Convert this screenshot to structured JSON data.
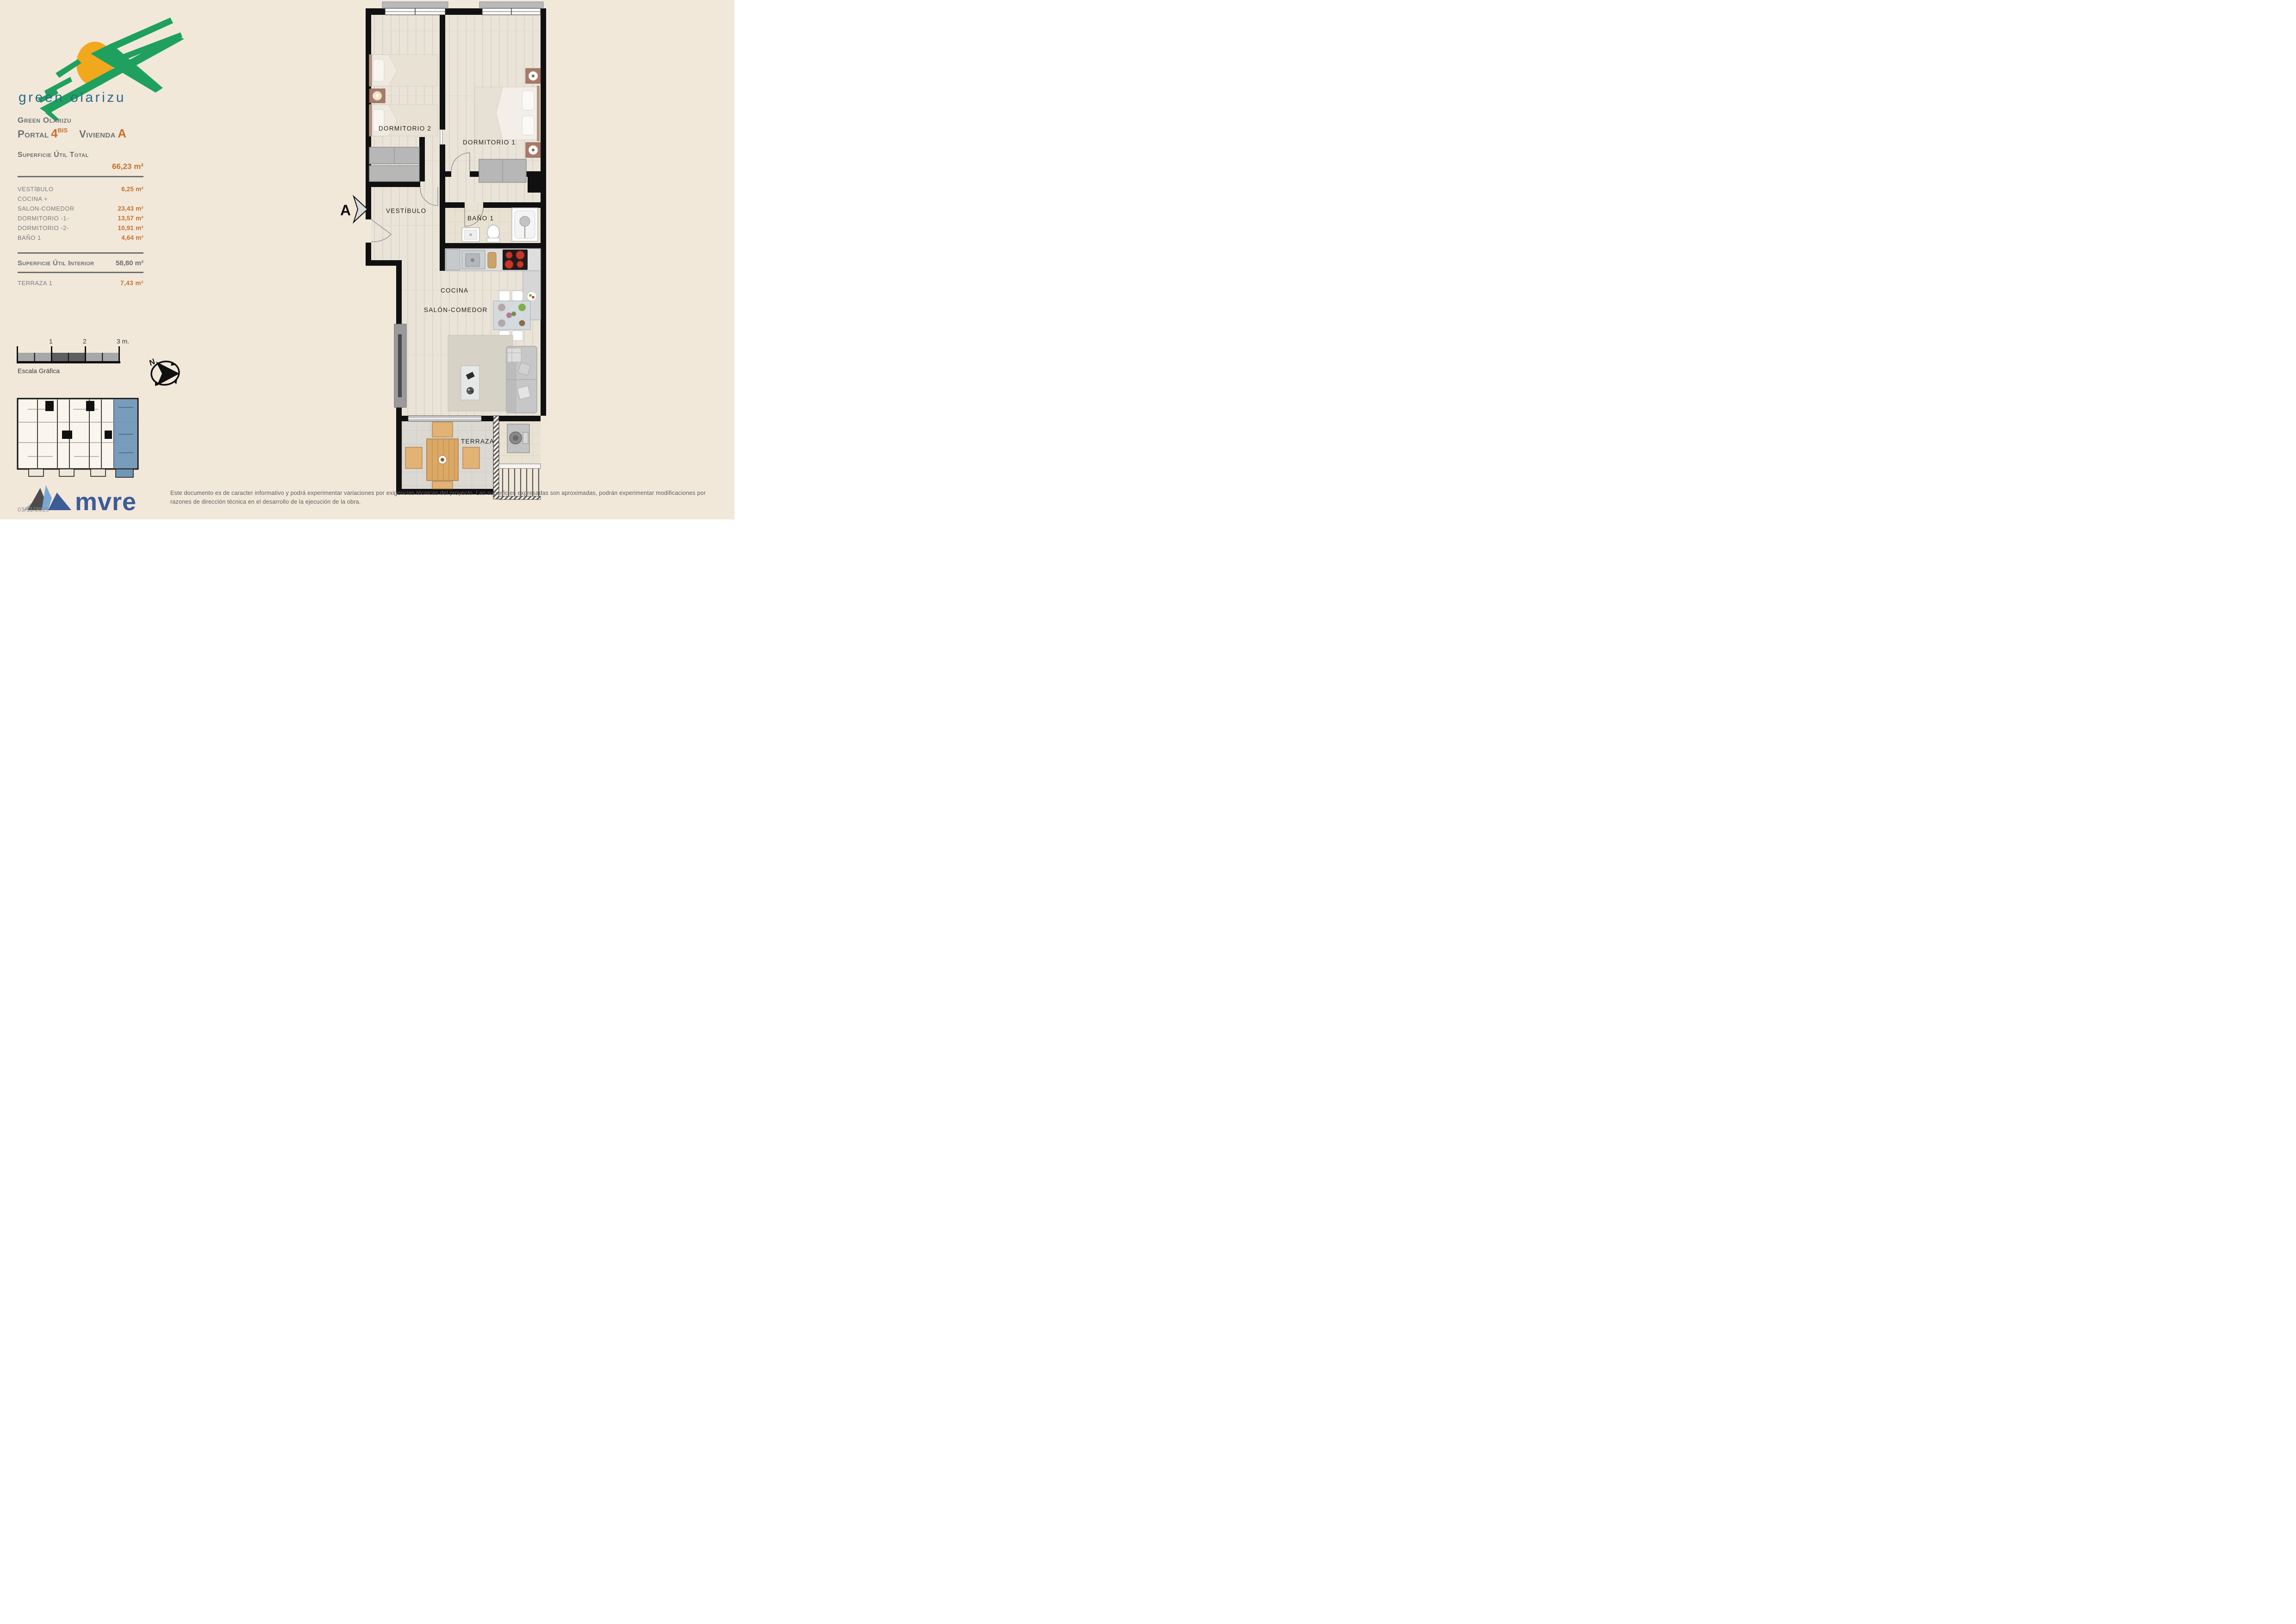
{
  "logo": {
    "wordmark": "green olarizu"
  },
  "header": {
    "project": "Green Olarizu",
    "portal_label": "Portal",
    "portal_number": "4",
    "portal_sup": "BIS",
    "unit_label": "Vivienda",
    "unit_letter": "A"
  },
  "areas": {
    "total_label": "Superficie Útil Total",
    "total_value": "66,23 m²",
    "rows": [
      {
        "label": "VESTÍBULO",
        "value": "6,25 m²"
      },
      {
        "label": "COCINA +",
        "value": ""
      },
      {
        "label": "SALON-COMEDOR",
        "value": "23,43 m²"
      },
      {
        "label": "DORMITORIO -1-",
        "value": "13,57 m²"
      },
      {
        "label": "DORMITORIO -2-",
        "value": "10,91 m²"
      },
      {
        "label": "BAÑO 1",
        "value": "4,64 m²"
      }
    ],
    "interior_label": "Superficie Útil Interior",
    "interior_value": "58,80 m²",
    "terrace_label": "TERRAZA 1",
    "terrace_value": "7,43 m²"
  },
  "scale_bar": {
    "ticks": [
      "1",
      "2",
      "3 m."
    ],
    "caption": "Escala Gráfica"
  },
  "compass": {
    "north_label": "N"
  },
  "plan": {
    "section_marker": "A",
    "rooms": {
      "dormitorio2": "DORMITORIO 2",
      "dormitorio1": "DORMITORIO 1",
      "vestibulo": "VESTÍBULO",
      "bano1": "BAÑO 1",
      "cocina": "COCINA",
      "salon": "SALÓN-COMEDOR",
      "terraza": "TERRAZA"
    }
  },
  "footer": {
    "brand": "mvre",
    "date": "03/11/2025",
    "disclaimer": "Este documento es de caracter informativo y podrá experimentar variaciones por exigencias técnicas del proyecto. Las superficies expresadas son aproximadas, podrán experimentar modificaciones por razones de dirección técnica en el desarrollo de la ejecución de la obra."
  },
  "colors": {
    "background": "#f1e8da",
    "accent_orange": "#c8702e",
    "text_gray": "#6e6f71",
    "wall_black": "#101010",
    "highlight_blue": "#7097b8",
    "brand_blue": "#3d5b97",
    "logo_green": "#1fa05f",
    "logo_sun": "#f2a81d",
    "logo_text_teal": "#2d6b85"
  }
}
